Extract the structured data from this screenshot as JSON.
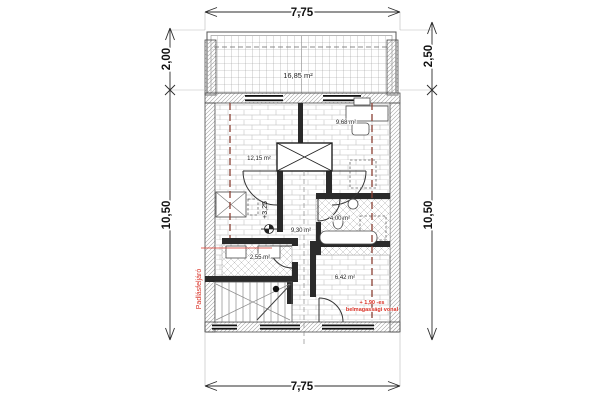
{
  "drawing_title": "attic floor plan",
  "dimensions": {
    "top": "7,75",
    "bottom": "7,75",
    "left_upper": "2,00",
    "left_main": "10,50",
    "right_upper": "2,50",
    "right_main": "10,50"
  },
  "rooms": {
    "terrace": "16,85 m²",
    "room_left": "12,15 m²",
    "room_right": "9,68 m²",
    "bathroom": "4,00 m²",
    "hall": "9,30 m²",
    "storage": "2,55 m²",
    "room_bottom": "6,42 m²"
  },
  "annotations": {
    "level_mark": "+3,25",
    "attic_stairs": "Padlásfeljáró",
    "height_line_label_1": "+ 1,90 -es",
    "height_line_label_2": "belmagassági vonal"
  },
  "colors": {
    "annotation_red": "#d93025",
    "height_line_dark_red": "#8a4034",
    "ink": "#1a1a1a",
    "hatch_gray": "#9a9a9a"
  }
}
